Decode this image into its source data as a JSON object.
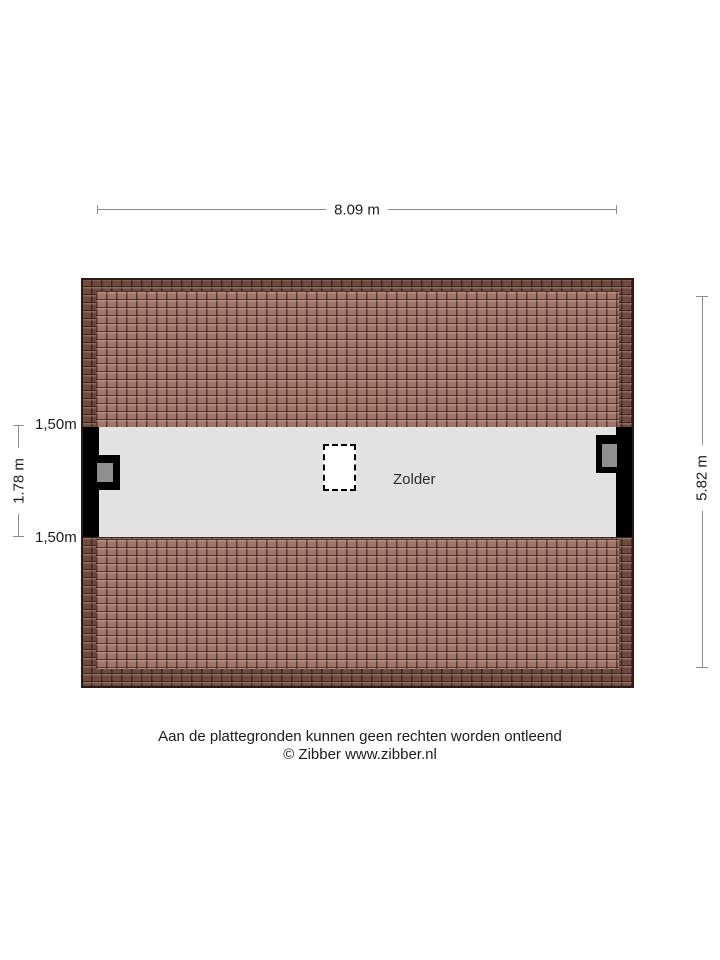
{
  "plan": {
    "room_label": "Zolder",
    "dimensions": {
      "width_top": "8.09 m",
      "height_right": "5.82 m",
      "attic_inner_height": "1.78 m",
      "knee_wall_top": "1,50m",
      "knee_wall_bottom": "1,50m"
    },
    "features": {
      "skylight": "dashed roof window",
      "chimney_left": "chimney with gray flue",
      "chimney_right": "chimney with gray flue"
    },
    "colors": {
      "tile_light": "#a17668",
      "tile_dark": "#6f4b3f",
      "floor": "#e2e2e2",
      "wall": "#000000",
      "chimney_gray": "#8f8f8f",
      "dimension_line": "#8c8c8c"
    }
  },
  "footer": {
    "disclaimer": "Aan de plattegronden kunnen geen rechten worden ontleend",
    "copyright": "© Zibber www.zibber.nl"
  }
}
